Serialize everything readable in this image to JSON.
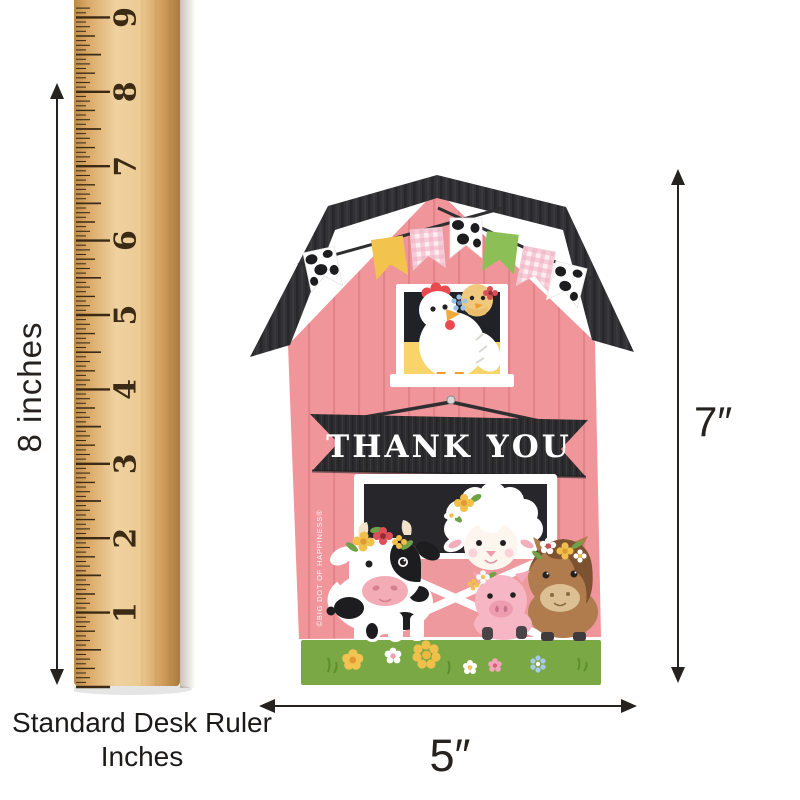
{
  "ruler": {
    "numbers": [
      "1",
      "2",
      "3",
      "4",
      "5",
      "6",
      "7",
      "8",
      "9"
    ],
    "height_label": "8 inches",
    "caption_line1": "Standard Desk Ruler",
    "caption_line2": "Inches"
  },
  "card": {
    "thank_you_label": "THANK YOU",
    "copyright_text": "©BIG DOT OF HAPPINESS®",
    "height_label": "7″",
    "width_label": "5″",
    "bunting_flags": [
      "cow-print",
      "yellow",
      "pink-gingham",
      "cow-print",
      "green",
      "pink-gingham",
      "cow-print"
    ],
    "animals": [
      "chick",
      "hen",
      "lamb",
      "cow",
      "pig",
      "pony"
    ],
    "grass_flowers": [
      "yellow",
      "white-daisy",
      "large-yellow-daisy",
      "white-daisy",
      "pink",
      "blue-aster"
    ]
  },
  "theme": {
    "barn_pink": "#f0969a",
    "plank_line": "#e28489",
    "roof_dark": "#323134",
    "banner_dark": "#2d2c2e",
    "grass_green": "#7aa844",
    "window_yellow": "#f8d46b",
    "window_dark": "#212227",
    "ruler_wood": "#e3b878",
    "tick_brown": "#3b2a14",
    "annotation_black": "#262220",
    "cow_black": "#1d1d1f",
    "pig_pink": "#f6b6c3",
    "pony_brown": "#b07c4e"
  }
}
